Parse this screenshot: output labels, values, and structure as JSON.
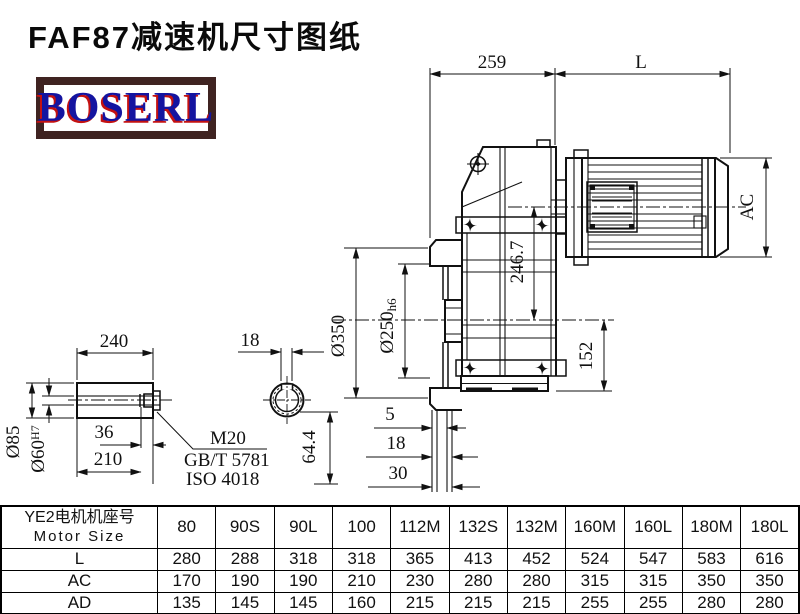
{
  "title": "FAF87减速机尺寸图纸",
  "logo": {
    "text": "BOSERL",
    "border_color": "#3f2321",
    "text_color": "#1414a0",
    "shadow_color": "#c41111"
  },
  "drawing": {
    "dims": {
      "w259": "259",
      "L": "L",
      "AC": "AC",
      "h246": "246.7",
      "h152": "152",
      "d350": "Ø350",
      "d250": "Ø250",
      "d250t": "h6",
      "s5": "5",
      "s18": "18",
      "s30": "30",
      "shaft240": "240",
      "key18": "18",
      "d85": "Ø85",
      "d60": "Ø60",
      "d60t": "H7",
      "b36": "36",
      "l210": "210",
      "k644": "64.4",
      "m20": "M20",
      "gbt": "GB/T 5781",
      "iso": "ISO 4018"
    }
  },
  "table": {
    "header_label_cn": "YE2电机机座号",
    "header_label_en": "Motor Size",
    "columns": [
      "80",
      "90S",
      "90L",
      "100",
      "112M",
      "132S",
      "132M",
      "160M",
      "160L",
      "180M",
      "180L"
    ],
    "rows": [
      {
        "label": "L",
        "values": [
          "280",
          "288",
          "318",
          "318",
          "365",
          "413",
          "452",
          "524",
          "547",
          "583",
          "616"
        ]
      },
      {
        "label": "AC",
        "values": [
          "170",
          "190",
          "190",
          "210",
          "230",
          "280",
          "280",
          "315",
          "315",
          "350",
          "350"
        ]
      },
      {
        "label": "AD",
        "values": [
          "135",
          "145",
          "145",
          "160",
          "215",
          "215",
          "215",
          "255",
          "255",
          "280",
          "280"
        ]
      }
    ]
  }
}
